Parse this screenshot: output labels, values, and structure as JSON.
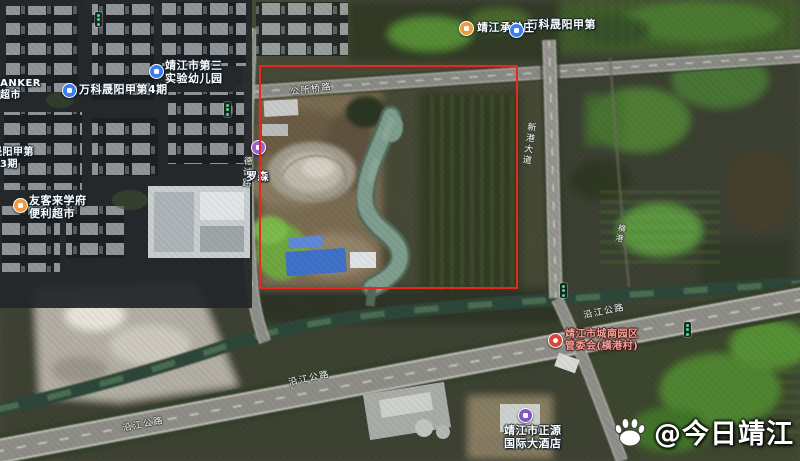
{
  "app": {
    "type": "satellite-map-screenshot",
    "city": "靖江"
  },
  "highlight": {
    "shape": "rectangle",
    "color": "#e8281e"
  },
  "pois": {
    "wanke_shengyang": {
      "label": "万科晟阳甲第",
      "icon_color": "#3b7df0"
    },
    "chenghan": {
      "label": "靖江承瀚庄",
      "icon_color": "#f09a3c"
    },
    "luosen": {
      "label": "罗森",
      "icon_color": "#a05fd0"
    },
    "kindergarten": {
      "line1": "靖江市第三",
      "line2": "实验幼儿园",
      "icon_color": "#3b7df0"
    },
    "wanke4": {
      "label": "万科晟阳甲第4期",
      "icon_color": "#3b7df0"
    },
    "banker": {
      "line1": "BANKER",
      "line2": "超市"
    },
    "edge_estate": {
      "line1": "晟阳甲第",
      "line2": "3期"
    },
    "youkelai": {
      "line1": "友客来学府",
      "line2": "便利超市",
      "icon_color": "#f09a3c"
    },
    "chengnan_badge": {
      "line1": "靖江市城南园区",
      "line2": "管委会(横港村)",
      "icon_color": "#d9453c",
      "text_color": "#f5a29a"
    },
    "hotel": {
      "line1": "靖江市正源",
      "line2": "国际大酒店",
      "icon_color": "#7e57c2"
    }
  },
  "road_labels": {
    "top_road": "公所桥路",
    "left_road": "德诚路",
    "right_road": "新港大道",
    "canal": "横港",
    "expressway": "沿江公路"
  },
  "watermark": {
    "handle": "@今日靖江",
    "logo": "baidu-paw-icon"
  }
}
